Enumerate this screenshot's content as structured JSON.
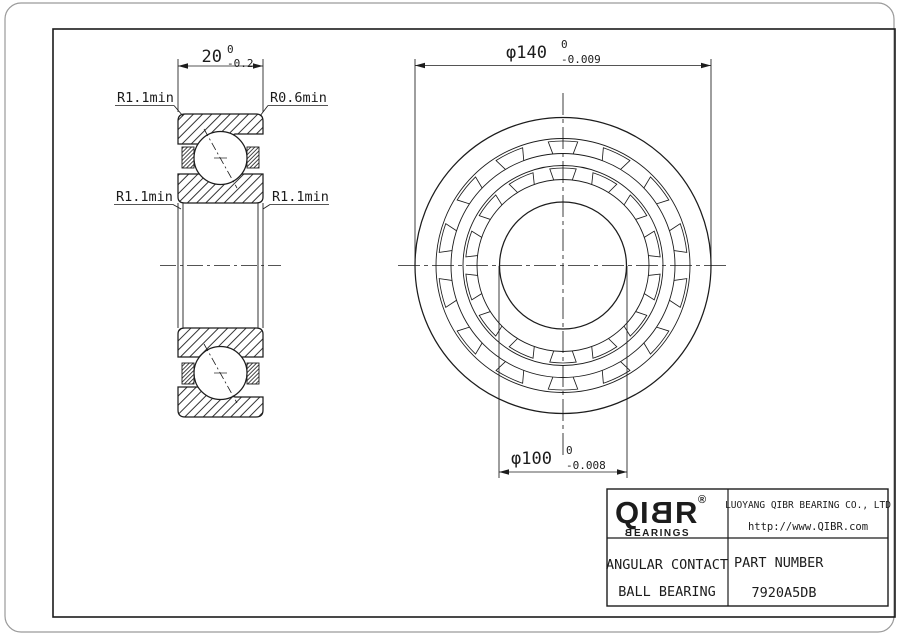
{
  "drawing": {
    "side_view": {
      "width_dim": {
        "nominal": "20",
        "upper": "0",
        "lower": "-0.2"
      },
      "labels": {
        "top_left": "R1.1min",
        "top_right": "R0.6min",
        "mid_left": "R1.1min",
        "mid_right": "R1.1min"
      }
    },
    "front_view": {
      "od_dim": {
        "nominal": "φ140",
        "upper": "0",
        "lower": "-0.009"
      },
      "bore_dim": {
        "nominal": "φ100",
        "upper": "0",
        "lower": "-0.008"
      }
    }
  },
  "title_block": {
    "logo": {
      "l1": "Q",
      "l2": "I",
      "l3": "B",
      "l4": "R",
      "registered": "®",
      "sub_b": "B",
      "sub_rest": "EARINGS"
    },
    "company_name": "LUOYANG QIBR BEARING CO., LTD",
    "company_url": "http://www.QIBR.com",
    "product_type_line1": "ANGULAR CONTACT",
    "product_type_line2": "BALL BEARING",
    "part_number_label": "PART NUMBER",
    "part_number": "7920A5DB"
  },
  "colors": {
    "line": "#1c1c1c",
    "background": "#ffffff",
    "outer_border": "#9a9a9a"
  }
}
